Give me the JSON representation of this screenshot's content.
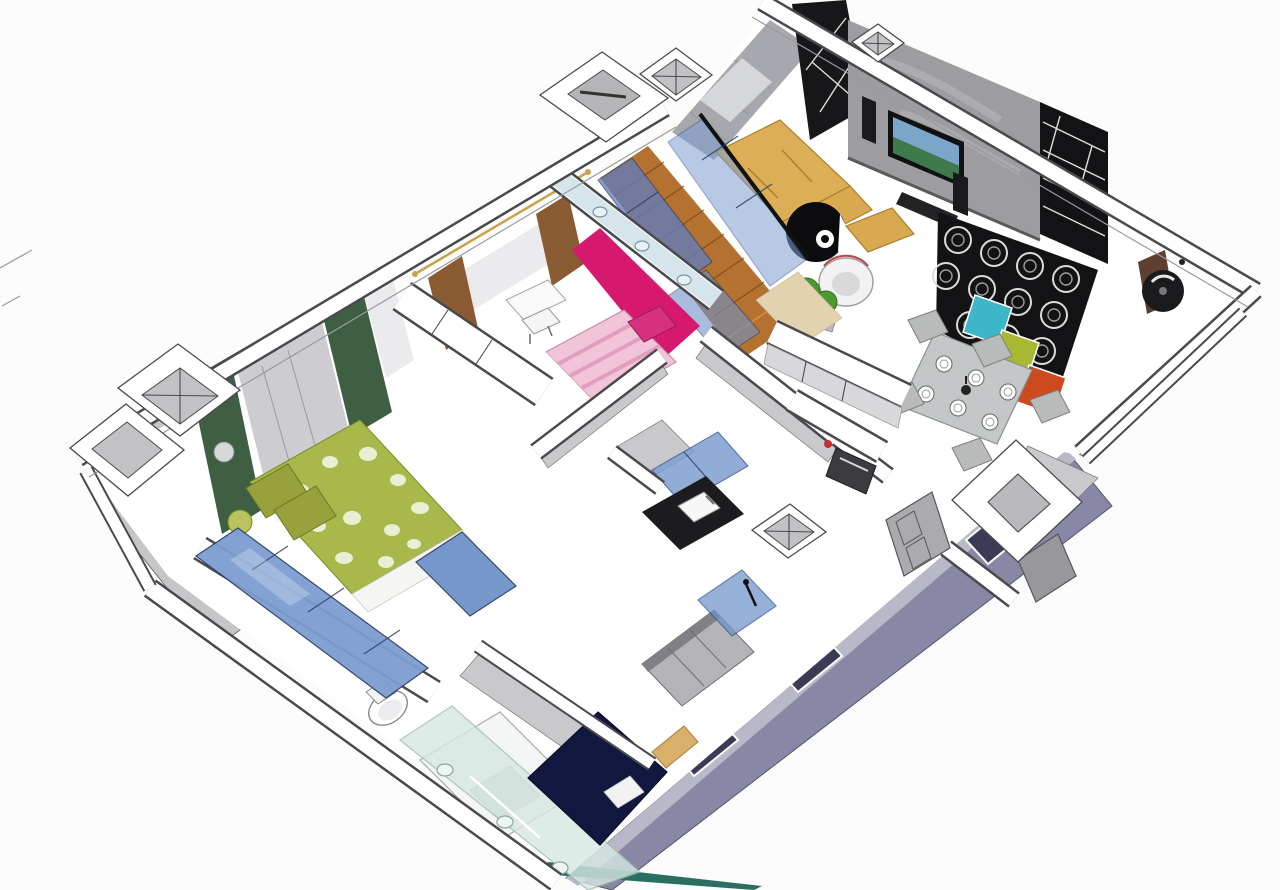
{
  "meta": {
    "kind": "3d-isometric-cutaway-floorplan",
    "render_style": "sketchup-like section perspective, no visible text or UI chrome",
    "canvas": {
      "width": 1280,
      "height": 890
    }
  },
  "colors": {
    "background": "#fcfcfc",
    "wall_fill": "#ffffff",
    "wall_line": "#4a4a4e",
    "wall_side_gray": "#c9c9cc",
    "balcony_gray": "#c6c6c8",
    "exterior_wall_purple": "#8887a6",
    "exterior_wall_purple_light": "#b9b8c9",
    "window_void_dark": "#3b3b55",
    "plinth_teal": "#2a6f63",
    "wood_floor": "#b5712f",
    "wood_floor_light": "#cd8a43",
    "accent_wall_pink": "#d6186f",
    "kids_bed_pink": "#f2c4d8",
    "kids_bed_stripe": "#e29ec0",
    "kids_pillow_magenta": "#d6317e",
    "curtain_brown": "#8a5a33",
    "curtain_green": "#3e5f41",
    "sheer_gray": "#c9c9cd",
    "sheer_white": "#e9e9ec",
    "curtain_rod_brown": "#8a4a26",
    "bedspread_green": "#a9b84a",
    "pillow_olive": "#97a23c",
    "wardrobe_blue": "#7d9ed1",
    "wardrobe_blue_deep": "#6f92c8",
    "glass_frame": "#2c3f66",
    "glass_teal_pale": "#d7e8e2",
    "sofa_yellow": "#dcae55",
    "table_yellow": "#d9a94f",
    "egg_chair_black": "#0c0c0e",
    "tv_wall_concrete": "#9d9d9f",
    "tv_screen_sky": "#7ca6c9",
    "tv_screen_land": "#3e7a4a",
    "shelf_black": "#131315",
    "box_cyan": "#3cb6c8",
    "box_lime": "#a9b832",
    "box_orange": "#cc4a1d",
    "dining_glass": "#c3c7c8",
    "chair_gray": "#b9bbba",
    "plant_green": "#4c9a2e",
    "bed_navy": "#11173f",
    "counter_black": "#1c1c1e",
    "door_gray": "#ababaf",
    "fan_black": "#1b1b1d",
    "fan_bracket_brown": "#5d4030"
  },
  "rooms": [
    {
      "id": "living-room",
      "features": [
        "yellow-corner-sofa",
        "black-egg-chair",
        "yellow-coffee-table",
        "white-armchair",
        "green-plants",
        "concrete-tv-wall",
        "wall-tv",
        "floor-speakers",
        "black-lattice-shelving",
        "storage-box-cyan",
        "storage-box-lime",
        "storage-box-orange",
        "gray-window-curtains",
        "black-slat-column",
        "wall-fan"
      ]
    },
    {
      "id": "dining-area",
      "features": [
        "glass-dining-table",
        "six-place-settings",
        "candle-centerpiece",
        "gray-upholstered-chairs"
      ]
    },
    {
      "id": "kitchen",
      "features": [
        "white-island-counter",
        "white-cabinet-run",
        "built-in-oven"
      ]
    },
    {
      "id": "hall-corridor",
      "features": [
        "herringbone-wood-floor",
        "blue-glass-sliding-panels",
        "glass-top-partition",
        "paneled-interior-doors",
        "square-column-with-void",
        "braced-column"
      ]
    },
    {
      "id": "kids-bedroom",
      "features": [
        "magenta-accent-wall",
        "pink-striped-single-bed",
        "magenta-pillow",
        "white-desk",
        "white-chair",
        "brown-window-drapes",
        "white-sheer-curtain",
        "built-in-wardrobe"
      ]
    },
    {
      "id": "master-bedroom",
      "features": [
        "green-floral-double-bed",
        "olive-pillows",
        "dark-green-drapes",
        "gray-sheer-curtains",
        "glossy-blue-wardrobe-doors",
        "curtain-rod"
      ]
    },
    {
      "id": "bathroom",
      "features": [
        "toilet",
        "bathtub",
        "pale-green-glass-screen"
      ]
    },
    {
      "id": "shower-room",
      "features": [
        "black-stone-vanity",
        "white-sink",
        "blue-mirror-cabinet",
        "blue-glass-shower-cabin",
        "black-shower-fixture"
      ]
    },
    {
      "id": "rear-bedroom",
      "features": [
        "navy-double-bed",
        "white-pillow",
        "wood-bench",
        "gray-wardrobe"
      ]
    },
    {
      "id": "exterior",
      "features": [
        "white-cut-walls",
        "gray-balconies",
        "cross-braced-columns",
        "ventilation-shaft",
        "purple-facade-wall-with-windows",
        "teal-plinth-strip",
        "site-boundary-dashes"
      ]
    }
  ]
}
